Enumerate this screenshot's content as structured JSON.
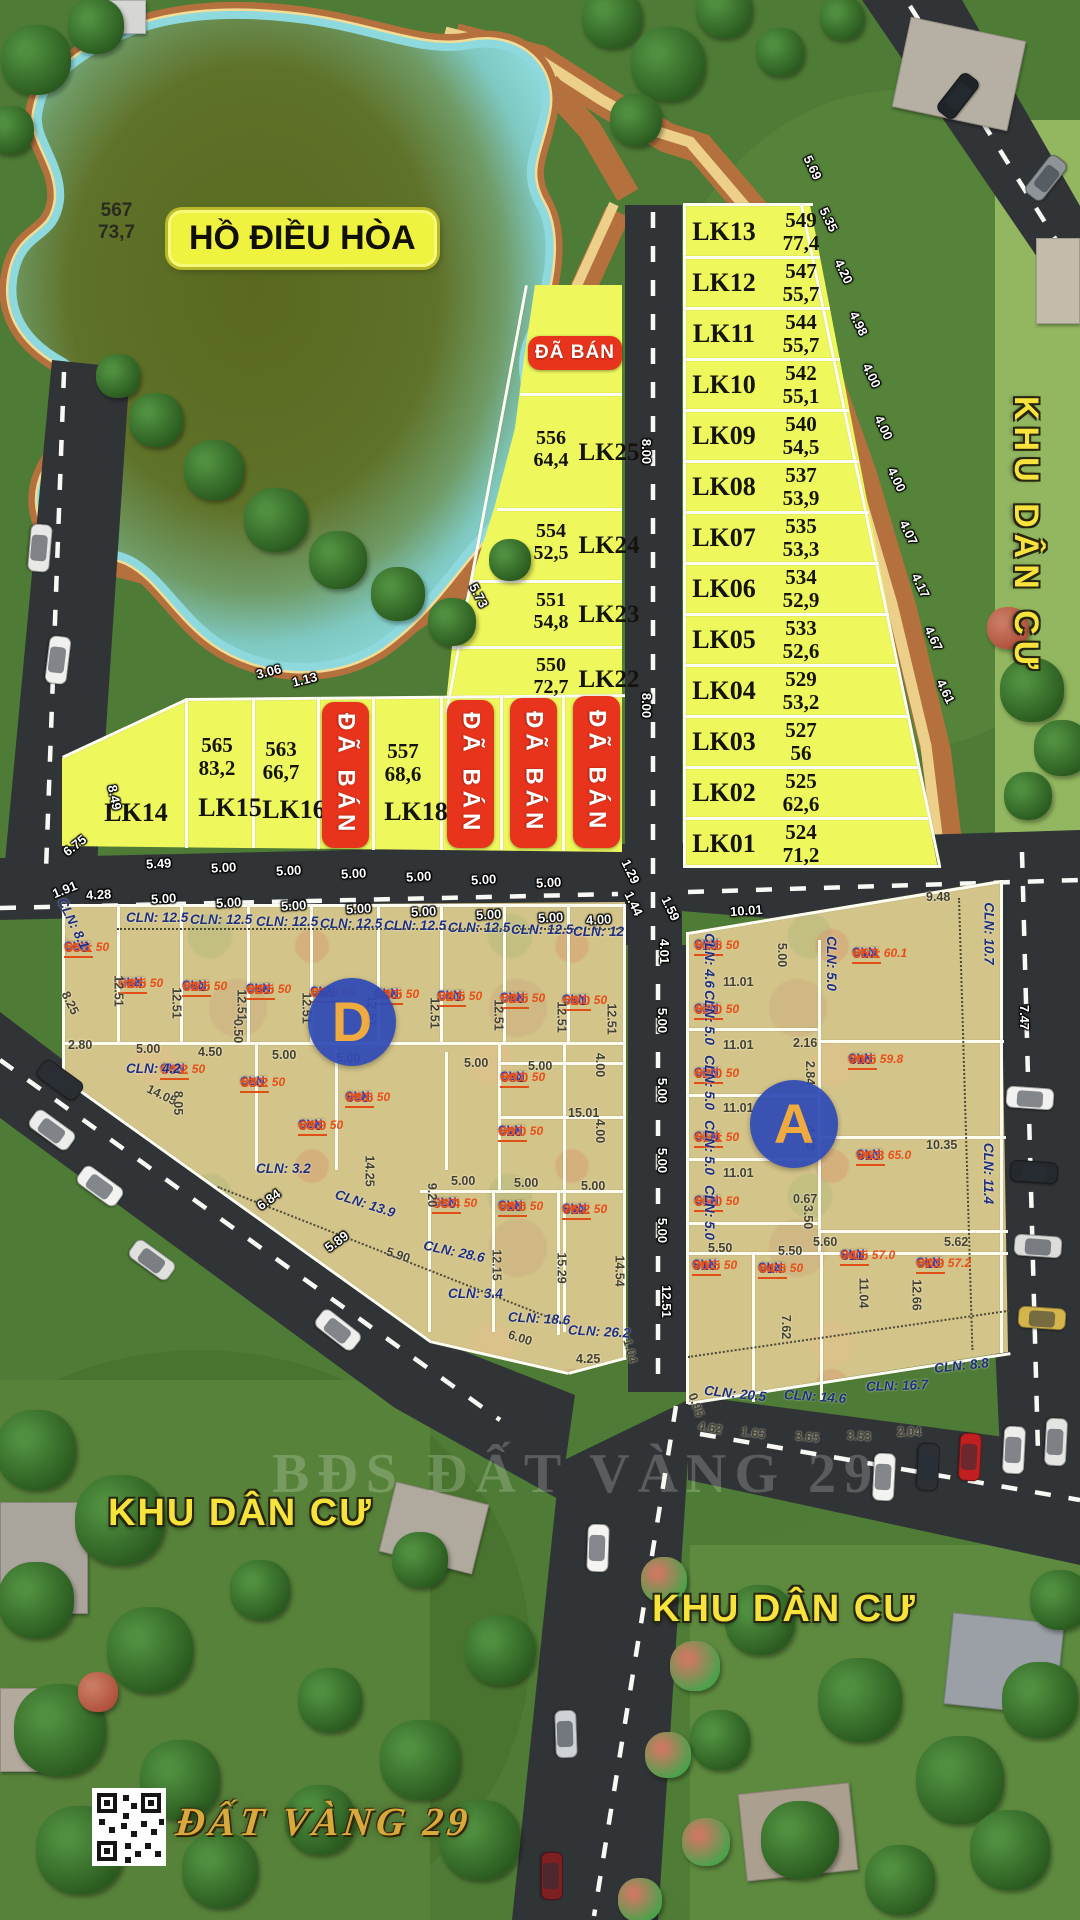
{
  "lake": {
    "label": "HỒ ĐIỀU HÒA",
    "parcel": "567",
    "area": "73,7"
  },
  "area_labels": {
    "right": "KHU DÂN CƯ",
    "bottom_left": "KHU DÂN CƯ",
    "bottom_right": "KHU DÂN CƯ"
  },
  "sold_label": "ĐÃ BÁN",
  "block_letters": {
    "d": "D",
    "a": "A"
  },
  "watermarks": {
    "center": "BĐS ĐẤT VÀNG 29",
    "bottom": "ĐẤT VÀNG 29"
  },
  "lk_right": [
    {
      "id": "LK13",
      "parcel": "549",
      "area": "77,4"
    },
    {
      "id": "LK12",
      "parcel": "547",
      "area": "55,7"
    },
    {
      "id": "LK11",
      "parcel": "544",
      "area": "55,7"
    },
    {
      "id": "LK10",
      "parcel": "542",
      "area": "55,1"
    },
    {
      "id": "LK09",
      "parcel": "540",
      "area": "54,5"
    },
    {
      "id": "LK08",
      "parcel": "537",
      "area": "53,9"
    },
    {
      "id": "LK07",
      "parcel": "535",
      "area": "53,3"
    },
    {
      "id": "LK06",
      "parcel": "534",
      "area": "52,9"
    },
    {
      "id": "LK05",
      "parcel": "533",
      "area": "52,6"
    },
    {
      "id": "LK04",
      "parcel": "529",
      "area": "53,2"
    },
    {
      "id": "LK03",
      "parcel": "527",
      "area": "56"
    },
    {
      "id": "LK02",
      "parcel": "525",
      "area": "62,6"
    },
    {
      "id": "LK01",
      "parcel": "524",
      "area": "71,2"
    }
  ],
  "lk_mid": [
    {
      "id": "LK25",
      "parcel": "556",
      "area": "64,4"
    },
    {
      "id": "LK24",
      "parcel": "554",
      "area": "52,5"
    },
    {
      "id": "LK23",
      "parcel": "551",
      "area": "54,8"
    },
    {
      "id": "LK22",
      "parcel": "550",
      "area": "72,7"
    }
  ],
  "lk_row": [
    {
      "id": "LK14"
    },
    {
      "id": "LK15",
      "parcel": "565",
      "area": "83,2"
    },
    {
      "id": "LK16",
      "parcel": "563",
      "area": "66,7"
    },
    {
      "id": "LK17",
      "sold": true
    },
    {
      "id": "LK18",
      "parcel": "557",
      "area": "68,6"
    },
    {
      "id": "LK19",
      "sold": true
    },
    {
      "id": "LK20",
      "sold": true
    },
    {
      "id": "LK21",
      "sold": true
    }
  ],
  "d_plots": [
    [
      "566",
      "58.1",
      "50",
      64,
      940
    ],
    [
      "564",
      "62.5",
      "50",
      118,
      976
    ],
    [
      "562",
      "62.5",
      "50",
      182,
      979
    ],
    [
      "558",
      "62.5",
      "50",
      246,
      982
    ],
    [
      "555",
      "62.5",
      "50",
      310,
      985
    ],
    [
      "548",
      "62.5",
      "50",
      374,
      987
    ],
    [
      "541",
      "62.5",
      "50",
      437,
      989
    ],
    [
      "536",
      "62.5",
      "50",
      500,
      991
    ],
    [
      "531",
      "62.0",
      "50",
      562,
      993
    ],
    [
      "560",
      "54.2",
      "50",
      160,
      1062
    ],
    [
      "553",
      "53.2",
      "50",
      240,
      1075
    ],
    [
      "538",
      "78.6",
      "50",
      345,
      1090
    ],
    [
      "546",
      "63.9",
      "50",
      298,
      1118
    ],
    [
      "532",
      "60.0",
      "50",
      500,
      1070
    ],
    [
      "528",
      "60.0",
      "50",
      498,
      1124
    ],
    [
      "530",
      "53.4",
      "50",
      432,
      1196
    ],
    [
      "526",
      "68.6",
      "50",
      498,
      1199
    ],
    [
      "522",
      "76.2",
      "50",
      562,
      1202
    ]
  ],
  "a_plots": [
    [
      "523",
      "54.6",
      "50",
      694,
      938
    ],
    [
      "521",
      "55.0",
      "50",
      694,
      1002
    ],
    [
      "520",
      "53.0",
      "50",
      694,
      1066
    ],
    [
      "519",
      "55.1",
      "50",
      694,
      1130
    ],
    [
      "518",
      "55.0",
      "50",
      694,
      1194
    ],
    [
      "516",
      "70.5",
      "50",
      692,
      1258
    ],
    [
      "514",
      "64.6",
      "50",
      758,
      1261
    ],
    [
      "517",
      "65.1",
      "60.1",
      852,
      946
    ],
    [
      "515",
      "70.5",
      "59.8",
      848,
      1052
    ],
    [
      "513",
      "76.8",
      "65.0",
      856,
      1148
    ],
    [
      "511",
      "74.5",
      "57.0",
      840,
      1248
    ],
    [
      "510",
      "67.9",
      "57.2",
      916,
      1256
    ]
  ],
  "dims_w": [
    [
      "5.69",
      800,
      160,
      64
    ],
    [
      "5.35",
      816,
      212,
      64
    ],
    [
      "4.20",
      831,
      264,
      64
    ],
    [
      "4.98",
      846,
      316,
      64
    ],
    [
      "4.00",
      859,
      368,
      64
    ],
    [
      "4.00",
      871,
      420,
      64
    ],
    [
      "4.00",
      884,
      472,
      64
    ],
    [
      "4.07",
      896,
      525,
      64
    ],
    [
      "4.17",
      908,
      578,
      64
    ],
    [
      "4.67",
      921,
      631,
      64
    ],
    [
      "4.61",
      933,
      684,
      64
    ],
    [
      "3.06",
      256,
      664,
      -14
    ],
    [
      "1.13",
      292,
      672,
      -14
    ],
    [
      "5.73",
      466,
      588,
      62
    ],
    [
      "8.00",
      634,
      444,
      90
    ],
    [
      "8.00",
      634,
      698,
      90
    ],
    [
      "8.49",
      102,
      790,
      78
    ],
    [
      "6.75",
      62,
      838,
      -38
    ],
    [
      "5.49",
      146,
      856,
      -3
    ],
    [
      "5.00",
      211,
      860,
      -3
    ],
    [
      "5.00",
      276,
      863,
      -3
    ],
    [
      "5.00",
      341,
      866,
      -3
    ],
    [
      "5.00",
      406,
      869,
      -3
    ],
    [
      "5.00",
      471,
      872,
      -3
    ],
    [
      "5.00",
      536,
      875,
      -3
    ],
    [
      "1.91",
      52,
      882,
      -22
    ],
    [
      "4.28",
      86,
      887,
      -3
    ],
    [
      "5.00",
      151,
      891,
      -3
    ],
    [
      "5.00",
      216,
      895,
      -3
    ],
    [
      "5.00",
      281,
      898,
      -3
    ],
    [
      "5.00",
      346,
      901,
      -3
    ],
    [
      "5.00",
      411,
      904,
      -3
    ],
    [
      "5.00",
      476,
      907,
      -3
    ],
    [
      "5.00",
      538,
      910,
      -3
    ],
    [
      "4.00",
      586,
      912,
      -3
    ],
    [
      "1.29",
      618,
      864,
      64
    ],
    [
      "1.44",
      621,
      896,
      64
    ],
    [
      "1.59",
      658,
      901,
      64
    ],
    [
      "10.01",
      730,
      903,
      -4
    ],
    [
      "4.01",
      652,
      944,
      90
    ],
    [
      "5.00",
      650,
      1013,
      90
    ],
    [
      "5.00",
      650,
      1083,
      90
    ],
    [
      "5.00",
      650,
      1153,
      90
    ],
    [
      "5.00",
      650,
      1223,
      90
    ],
    [
      "12.51",
      650,
      1294,
      90
    ],
    [
      "6.84",
      256,
      1192,
      -36
    ],
    [
      "5.89",
      324,
      1234,
      -36
    ],
    [
      "7.47",
      1012,
      1010,
      90
    ]
  ],
  "dims_d": [
    [
      "2.80",
      68,
      1038,
      0
    ],
    [
      "5.00",
      136,
      1042,
      0
    ],
    [
      "4.50",
      198,
      1045,
      0
    ],
    [
      "0.50",
      226,
      1024,
      90
    ],
    [
      "5.00",
      272,
      1048,
      0
    ],
    [
      "5.00",
      336,
      1051,
      0
    ],
    [
      "5.00",
      464,
      1056,
      0
    ],
    [
      "5.00",
      528,
      1059,
      0
    ],
    [
      "15.01",
      568,
      1106,
      0
    ],
    [
      "4.00",
      588,
      1058,
      90
    ],
    [
      "4.00",
      588,
      1124,
      90
    ],
    [
      "14.05",
      146,
      1088,
      26
    ],
    [
      "8.05",
      166,
      1096,
      90
    ],
    [
      "8.25",
      58,
      996,
      64
    ],
    [
      "12.51",
      103,
      984,
      90
    ],
    [
      "12.51",
      161,
      996,
      90
    ],
    [
      "12.51",
      226,
      998,
      90
    ],
    [
      "12.51",
      291,
      1001,
      90
    ],
    [
      "12.51",
      356,
      1004,
      90
    ],
    [
      "12.51",
      419,
      1006,
      90
    ],
    [
      "12.51",
      483,
      1008,
      90
    ],
    [
      "12.51",
      546,
      1010,
      90
    ],
    [
      "12.51",
      596,
      1012,
      90
    ],
    [
      "9.20",
      420,
      1188,
      90
    ],
    [
      "14.25",
      354,
      1164,
      90
    ],
    [
      "5.90",
      386,
      1248,
      18
    ],
    [
      "12.15",
      481,
      1258,
      90
    ],
    [
      "15.29",
      546,
      1261,
      90
    ],
    [
      "14.54",
      604,
      1264,
      90
    ],
    [
      "5.00",
      451,
      1174,
      0
    ],
    [
      "5.00",
      514,
      1176,
      0
    ],
    [
      "5.00",
      581,
      1179,
      0
    ],
    [
      "6.00",
      508,
      1331,
      18
    ],
    [
      "4.25",
      576,
      1352,
      0
    ],
    [
      "1.04",
      618,
      1344,
      75
    ],
    [
      "9.48",
      926,
      890,
      0
    ],
    [
      "10.35",
      926,
      1138,
      0
    ],
    [
      "11.01",
      723,
      975,
      0
    ],
    [
      "11.01",
      723,
      1038,
      0
    ],
    [
      "11.01",
      723,
      1101,
      0
    ],
    [
      "11.01",
      723,
      1166,
      0
    ],
    [
      "2.16",
      793,
      1036,
      0
    ],
    [
      "2.84",
      798,
      1066,
      90
    ],
    [
      "4.33",
      798,
      1131,
      90
    ],
    [
      "0.67",
      793,
      1192,
      0
    ],
    [
      "3.50",
      796,
      1210,
      90
    ],
    [
      "5.50",
      708,
      1241,
      0
    ],
    [
      "5.50",
      778,
      1244,
      0
    ],
    [
      "5.60",
      813,
      1235,
      0
    ],
    [
      "5.62",
      944,
      1235,
      0
    ],
    [
      "11.04",
      848,
      1286,
      90
    ],
    [
      "12.66",
      901,
      1288,
      90
    ],
    [
      "7.62",
      774,
      1320,
      90
    ],
    [
      "0.95",
      684,
      1398,
      70
    ],
    [
      "4.62",
      698,
      1421,
      10
    ],
    [
      "1.65",
      741,
      1426,
      8
    ],
    [
      "3.65",
      795,
      1430,
      5
    ],
    [
      "3.53",
      847,
      1429,
      3
    ],
    [
      "2.04",
      897,
      1425,
      0
    ],
    [
      "5.00",
      770,
      948,
      90
    ]
  ],
  "dims_n": [
    [
      "CLN: 12.5",
      126,
      910,
      0
    ],
    [
      "CLN: 12.5",
      190,
      912,
      0
    ],
    [
      "CLN: 12.5",
      256,
      914,
      0
    ],
    [
      "CLN: 12.5",
      320,
      916,
      0
    ],
    [
      "CLN: 12.5",
      384,
      918,
      0
    ],
    [
      "CLN: 12.5",
      448,
      920,
      0
    ],
    [
      "CLN: 12.5",
      511,
      922,
      0
    ],
    [
      "CLN: 12",
      573,
      924,
      0
    ],
    [
      "CLN: 8.1",
      46,
      916,
      64
    ],
    [
      "CLN: 4.2",
      126,
      1061,
      0
    ],
    [
      "CLN: 3.2",
      256,
      1161,
      0
    ],
    [
      "CLN: 13.9",
      334,
      1196,
      18
    ],
    [
      "CLN: 28.6",
      423,
      1244,
      12
    ],
    [
      "CLN: 3.4",
      448,
      1286,
      0
    ],
    [
      "CLN: 18.6",
      508,
      1311,
      3
    ],
    [
      "CLN: 26.2",
      568,
      1324,
      3
    ],
    [
      "CLN: 4.6",
      682,
      953,
      90
    ],
    [
      "CLN: 5.0",
      682,
      1010,
      90
    ],
    [
      "CLN: 5.0",
      682,
      1075,
      90
    ],
    [
      "CLN: 5.0",
      682,
      1140,
      90
    ],
    [
      "CLN: 5.0",
      682,
      1205,
      90
    ],
    [
      "CLN: 5.0",
      804,
      956,
      90
    ],
    [
      "CLN: 10.7",
      958,
      926,
      90
    ],
    [
      "CLN: 11.4",
      958,
      1166,
      90
    ],
    [
      "CLN: 20.5",
      704,
      1386,
      6
    ],
    [
      "CLN: 14.6",
      784,
      1389,
      4
    ],
    [
      "CLN: 16.7",
      866,
      1378,
      -2
    ],
    [
      "CLN: 8.8",
      934,
      1358,
      -6
    ]
  ],
  "banners": [
    [
      528,
      336,
      94,
      34,
      0
    ],
    [
      322,
      702,
      47,
      146,
      1
    ],
    [
      447,
      700,
      47,
      148,
      1
    ],
    [
      510,
      698,
      47,
      150,
      1
    ],
    [
      573,
      696,
      47,
      152,
      1
    ]
  ]
}
